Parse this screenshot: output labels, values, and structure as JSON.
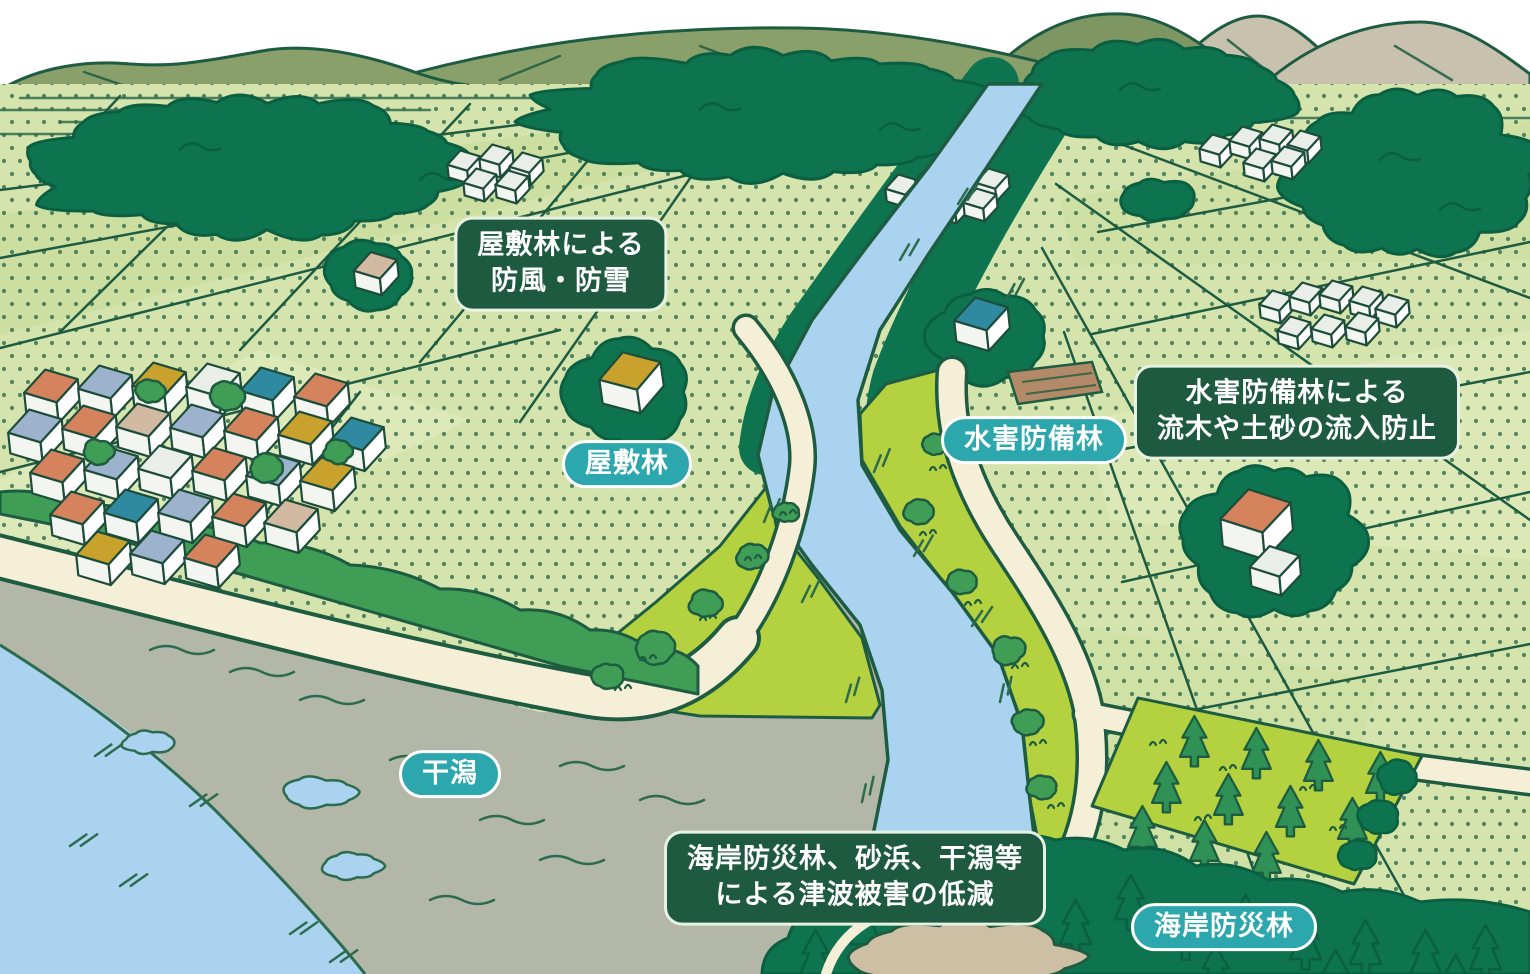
{
  "callouts": [
    {
      "id": "yashikirin-function",
      "lines": [
        "屋敷林による",
        "防風・防雪"
      ]
    },
    {
      "id": "suigaiboubirin-function",
      "lines": [
        "水害防備林による",
        "流木や土砂の流入防止"
      ]
    },
    {
      "id": "kaiganbousairin-function",
      "lines": [
        "海岸防災林、砂浜、干潟等",
        "による津波被害の低減"
      ]
    }
  ],
  "pills": [
    {
      "id": "yashikirin",
      "text": "屋敷林"
    },
    {
      "id": "suigaiboubirin",
      "text": "水害防備林"
    },
    {
      "id": "higata",
      "text": "干潟"
    },
    {
      "id": "kaiganbousairin",
      "text": "海岸防災林"
    }
  ],
  "colors": {
    "outline": "#1e5c42",
    "sky": "#ffffff",
    "mountain_olive": "#8aa06b",
    "mountain_olive_dark": "#7e9762",
    "mountain_beige": "#c8c1ae",
    "field": "#d5e4ad",
    "field_tint_light": "#e0ebbd",
    "field_tint_dark": "#cadd9c",
    "field_dot": "#2f6c4e",
    "forest": "#0e7450",
    "forest_line": "#0a5f40",
    "tree_mid": "#3f9d55",
    "grass": "#b4d13f",
    "river": "#a9d3ef",
    "cream": "#f6efd7",
    "tidal_gray": "#b2b7a8",
    "sand": "#ccbfa3",
    "soil": "#b28a67",
    "house_wall": "#ffffff",
    "roof_orange": "#d4835c",
    "roof_mustard": "#c8a22c",
    "roof_blue": "#9db3cd",
    "roof_teal": "#2f89a0",
    "roof_beige": "#d2b9a2",
    "roof_white": "#e9efe8",
    "water_line": "#2c6b4e",
    "callout_bg": "#1d5a40",
    "callout_border": "#e7f2e3",
    "callout_text": "#ffffff",
    "pill_bg": "#2ca7ae",
    "pill_border": "#ffffff",
    "pill_text": "#ffffff"
  }
}
